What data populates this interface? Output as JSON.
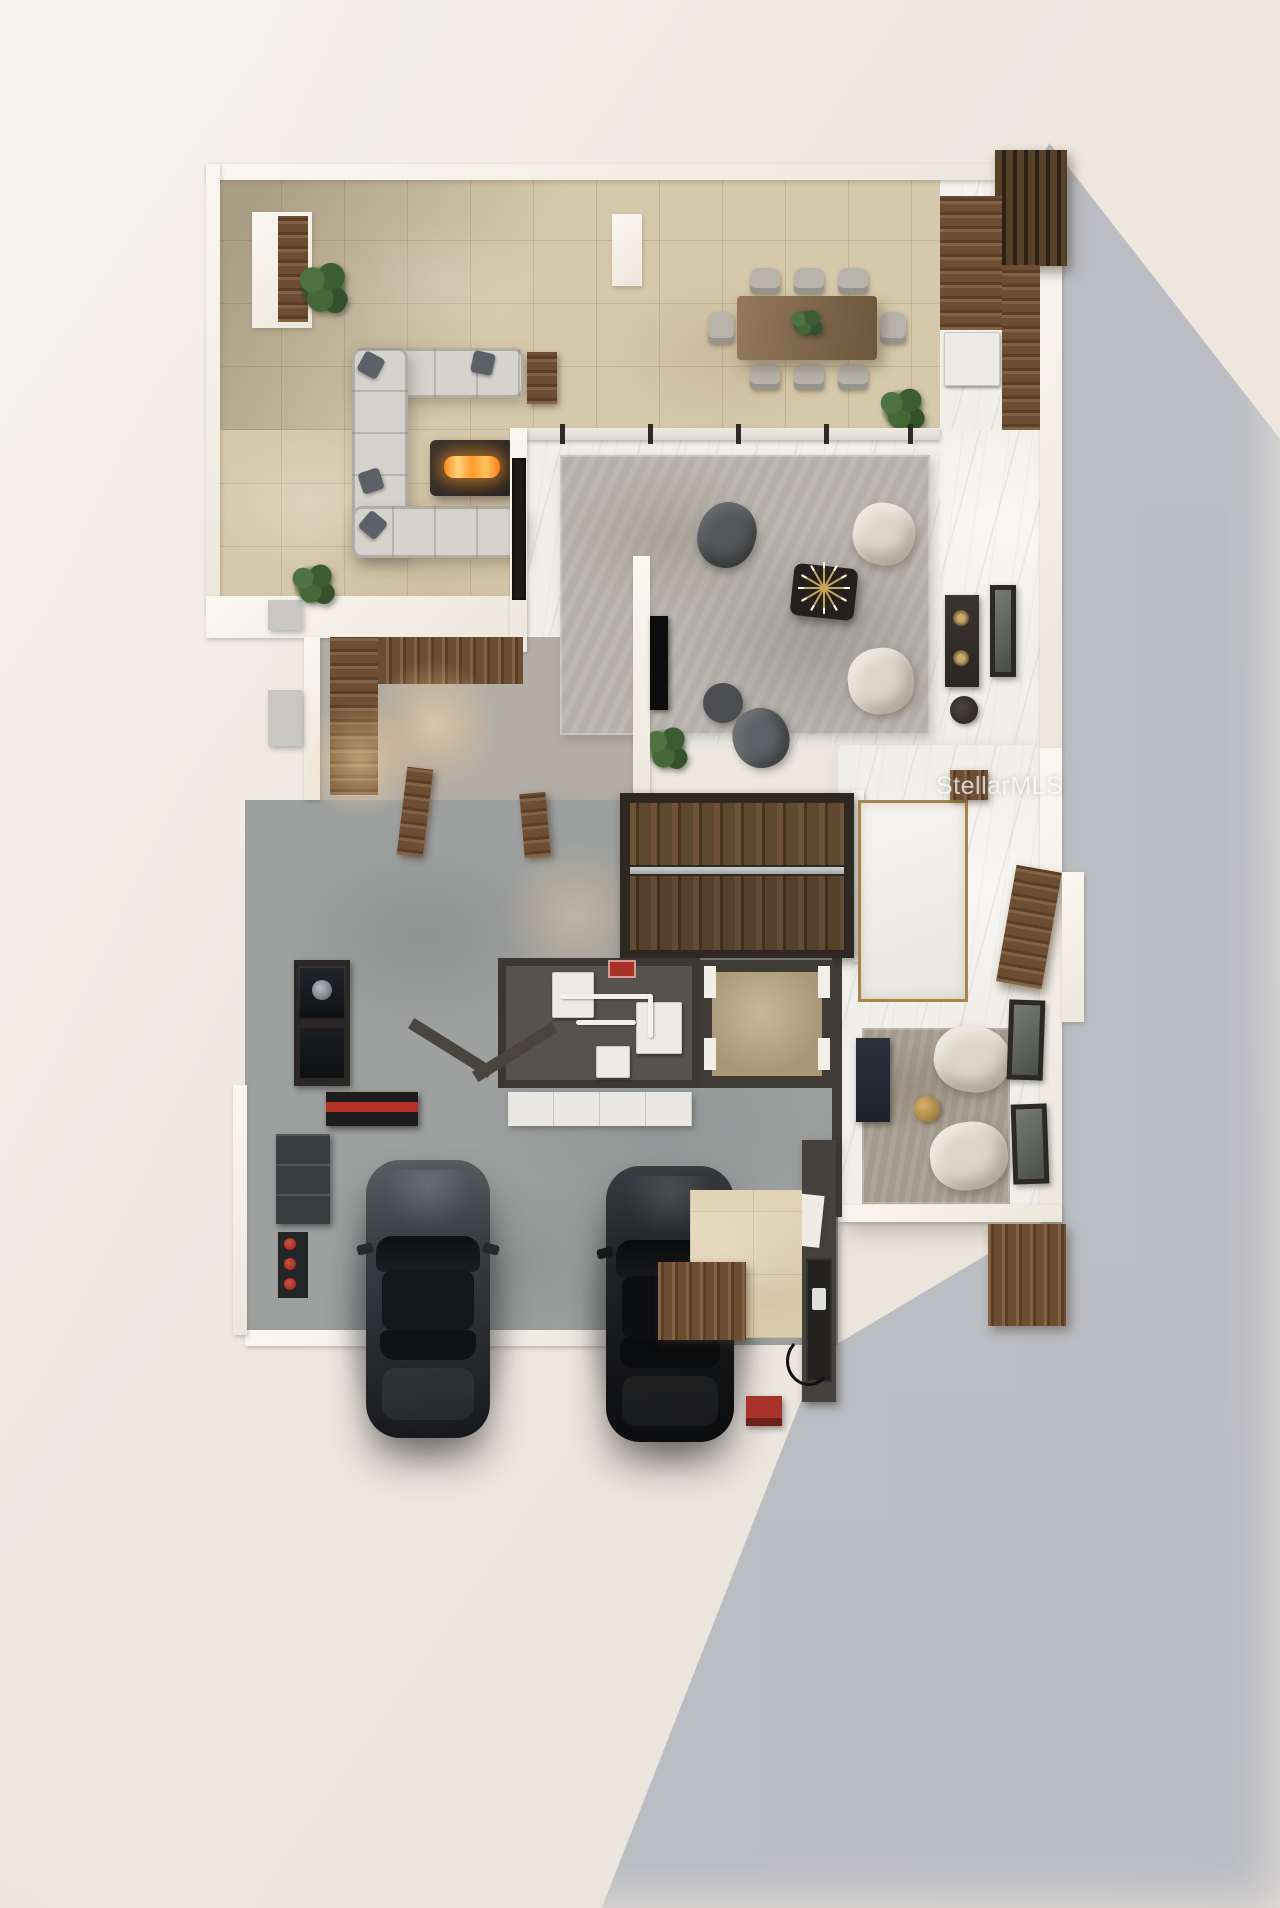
{
  "meta": {
    "kind": "3d-rendered-floor-plan",
    "width": 1280,
    "height": 1908
  },
  "watermark": {
    "text": "StellarMLS"
  },
  "palette": {
    "background": "#efe9e2",
    "cast_shadow": "#b5b8bf",
    "travertine": "#d6c9ab",
    "marble": "#f1efe9",
    "concrete": "#b2aea6",
    "garage_floor": "#9da09f",
    "walnut": "#6d4e33",
    "stair_wood": "#5b4530",
    "wall_white": "#f6f3ec",
    "dark_wall": "#3f3b36",
    "rug_gray": "#b5b1aa",
    "rug_tan": "#a49b8e",
    "sofa_gray": "#d6d3cd",
    "chair_cream": "#ded7c8",
    "fire_glow": "#ff9a2a",
    "brass": "#a5854e",
    "accent_red": "#a83227",
    "plant_green": "#3c5c31",
    "car_gray": "#3a3d42",
    "car_black": "#17181a"
  },
  "rooms": [
    "outdoor-lounge-lanai",
    "dining-terrace",
    "cabana-room",
    "family-room",
    "powder-room",
    "office-entry",
    "foyer-hall",
    "staircase",
    "entry-hall",
    "sitting-nook",
    "utility-room",
    "storage-closet",
    "mudroom",
    "garage"
  ],
  "inventory": {
    "cars": 2,
    "dining_chairs": 8,
    "lounge_chairs": 4,
    "plants": 4,
    "framed_art": 2,
    "objects": [
      "outdoor-sectional-sofa",
      "fire-pit-table",
      "dining-table",
      "centerpiece-plant",
      "sputnik-chandelier",
      "coffee-table",
      "tv-panel",
      "fireplace",
      "vanity",
      "toilet",
      "floor-inlay-brass",
      "front-door",
      "interior-doors",
      "water-heaters",
      "pipes",
      "ev-charger",
      "workbench",
      "tool-cart",
      "coffee-station",
      "storage-cabinets",
      "glass-railing"
    ]
  }
}
